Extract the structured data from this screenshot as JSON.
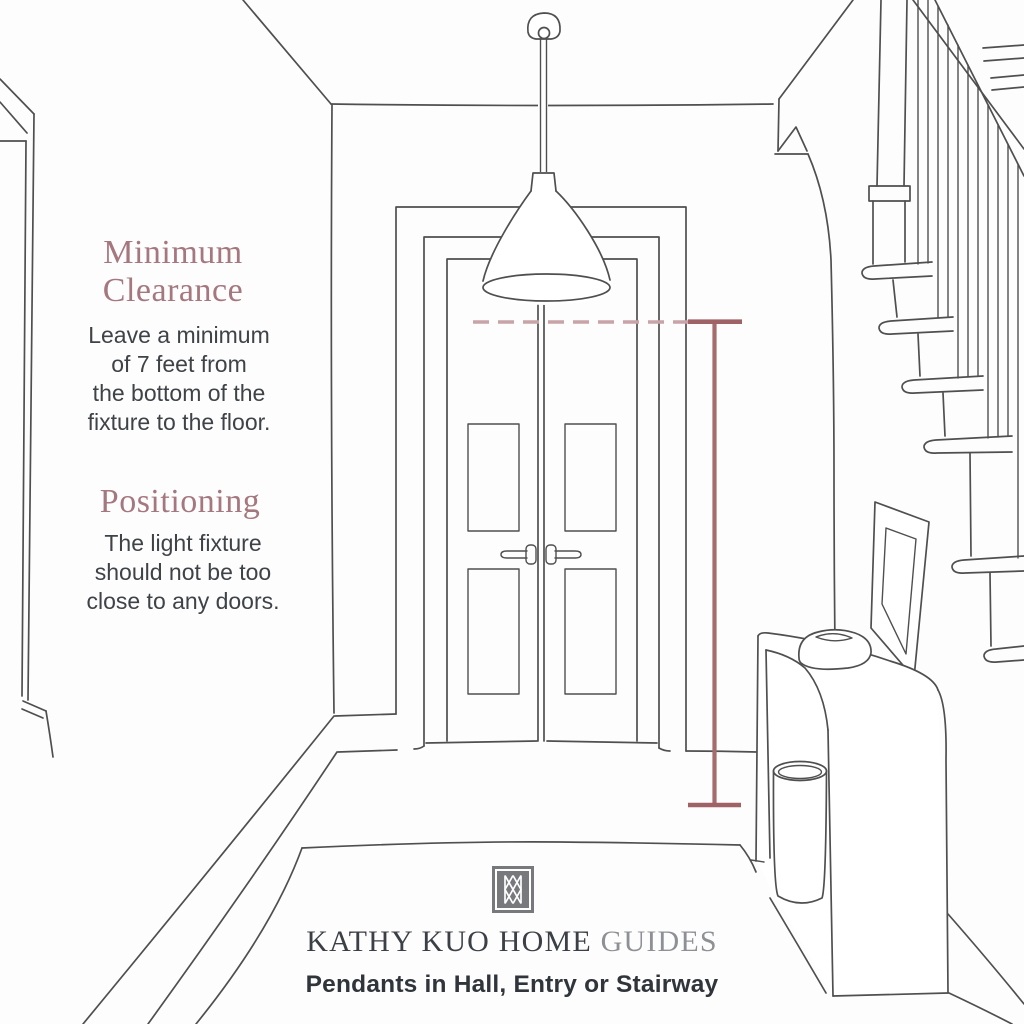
{
  "palette": {
    "background": "#fdfdfd",
    "line_art": "#4f4f4f",
    "heading": "#a5777e",
    "body_text": "#3e4347",
    "measurement_line": "#a66b6e",
    "clearance_dashed_line": "#c8a3a8",
    "logo_gray": "#77797c",
    "brand_dark": "#3b4046",
    "brand_light": "#8d9195",
    "subtitle_text": "#2f353a"
  },
  "sections": {
    "minimum_clearance": {
      "title": "Minimum\nClearance",
      "body": "Leave a minimum\nof 7 feet from\nthe bottom of the\nfixture to the floor."
    },
    "positioning": {
      "title": "Positioning",
      "body": "The light fixture\nshould not be too\nclose to any doors."
    }
  },
  "footer": {
    "logo": "kathy-kuo-home-monogram",
    "brand_primary": "KATHY KUO HOME",
    "brand_secondary": "GUIDES",
    "subtitle": "Pendants in Hall, Entry or Stairway"
  },
  "scene": {
    "elements": [
      "pendant-light",
      "double-doors",
      "staircase",
      "handrail",
      "balusters",
      "console-table",
      "leaning-frame",
      "basket",
      "decor-bowl",
      "rug",
      "clearance-dashed-line",
      "measurement-line"
    ]
  }
}
